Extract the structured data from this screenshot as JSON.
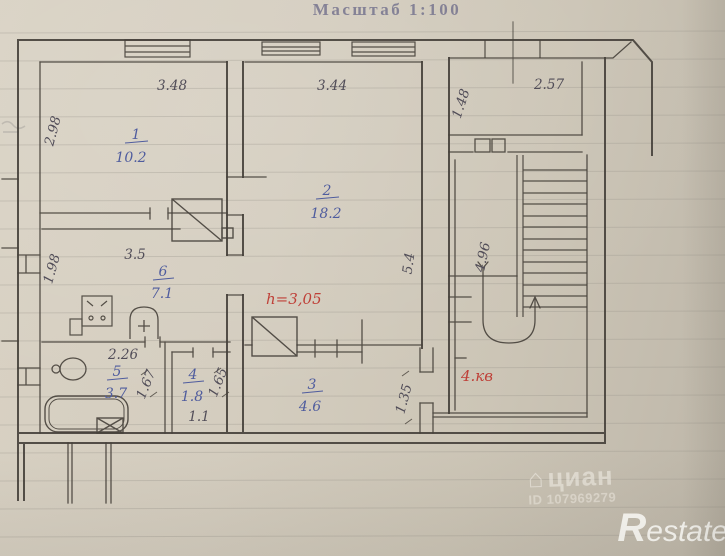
{
  "title": "Масштаб 1:100",
  "plan": {
    "rooms": [
      {
        "number": "1",
        "area": "10.2"
      },
      {
        "number": "2",
        "area": "18.2"
      },
      {
        "number": "3",
        "area": "4.6"
      },
      {
        "number": "4",
        "area": "1.8"
      },
      {
        "number": "5",
        "area": "3.7"
      },
      {
        "number": "6",
        "area": "7.1"
      }
    ],
    "dimensions": {
      "room1_width": "3.48",
      "room1_depth": "2.98",
      "room2_width": "3.44",
      "room2_depth": "5.4",
      "entry_room_width": "2.57",
      "entry_room_depth": "1.48",
      "stairwell_depth": "4.96",
      "kitchen_width": "3.5",
      "kitchen_depth": "1.98",
      "bath_width": "2.26",
      "bath_wall": "1.67",
      "wc_depth": "1.65",
      "wc_width": "1.1",
      "hall_depth": "1.35"
    },
    "notes": {
      "ceiling_height": "h=3,05",
      "apartment": "4.кв"
    }
  },
  "watermarks": {
    "cian": "циан",
    "cian_id": "ID 107969279",
    "restate_r": "R",
    "restate_rest": "estate",
    "house_icon": "⌂"
  }
}
